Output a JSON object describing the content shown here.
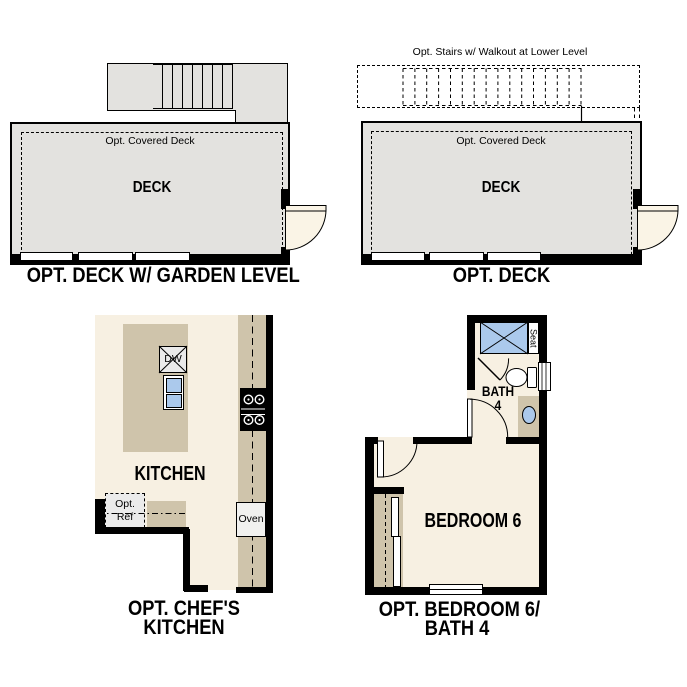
{
  "colors": {
    "deck_gray": "#e3e2df",
    "floor_cream": "#f7f0e2",
    "cabinet_tan": "#cfc4ab",
    "fixture_blue": "#abc9ec",
    "wall_black": "#000000",
    "appliance_gray": "#eaeaea"
  },
  "plans": {
    "deck_garden": {
      "title": "OPT. DECK W/ GARDEN LEVEL",
      "room": "DECK",
      "covered": "Opt. Covered Deck"
    },
    "deck": {
      "title": "OPT. DECK",
      "room": "DECK",
      "covered": "Opt. Covered Deck",
      "stairs_note": "Opt. Stairs w/ Walkout at Lower Level"
    },
    "chefs_kitchen": {
      "title_line1": "OPT. CHEF'S",
      "title_line2": "KITCHEN",
      "room": "KITCHEN",
      "dishwasher": "DW",
      "oven": "Oven",
      "ref_line1": "Opt.",
      "ref_line2": "Ref"
    },
    "bedroom_bath": {
      "title_line1": "OPT. BEDROOM 6/",
      "title_line2": "BATH 4",
      "room": "BEDROOM 6",
      "bath_line1": "BATH",
      "bath_line2": "4",
      "seat": "Seat"
    }
  }
}
